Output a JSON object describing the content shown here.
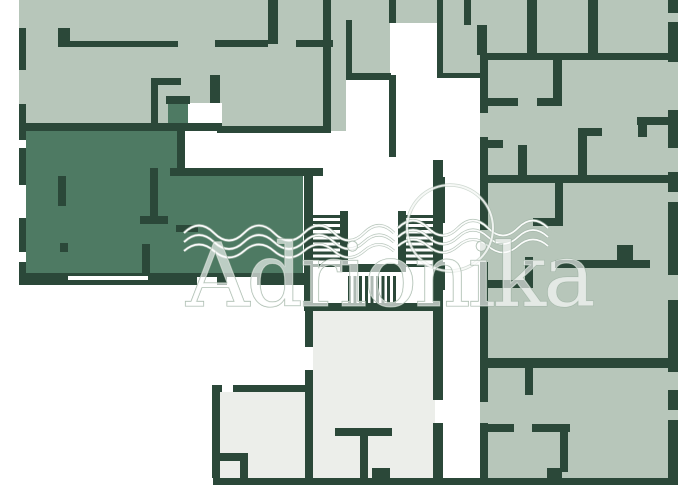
{
  "watermark": {
    "text": "Adrionika"
  },
  "colors": {
    "bg": "#ffffff",
    "room": "#b7c6ba",
    "room-dark": "#4e7a63",
    "room-pale": "#eceeea",
    "wall": "#2b4839",
    "wm-stroke": "#9fb3a4"
  },
  "plan": {
    "width": 692,
    "height": 485,
    "shapes": [
      {
        "t": "sage",
        "n": "apartment-fill-top-left",
        "x": 19,
        "y": 0,
        "w": 424,
        "h": 133
      },
      {
        "t": "sage",
        "n": "apartment-fill-right",
        "x": 443,
        "y": 0,
        "w": 235,
        "h": 478
      },
      {
        "t": "dark",
        "n": "highlighted-apartment-fill",
        "x": 26,
        "y": 128,
        "w": 277,
        "h": 149
      },
      {
        "t": "dark",
        "n": "highlighted-apartment-entry-fill",
        "x": 168,
        "y": 103,
        "w": 20,
        "h": 27
      },
      {
        "t": "pale",
        "n": "apartment-fill-bottom-center",
        "x": 313,
        "y": 310,
        "w": 122,
        "h": 168
      },
      {
        "t": "pale",
        "n": "apartment-fill-bottom-left",
        "x": 220,
        "y": 392,
        "w": 85,
        "h": 86
      },
      {
        "t": "white",
        "n": "door-opening",
        "x": 188,
        "y": 103,
        "w": 34,
        "h": 21
      },
      {
        "t": "white",
        "n": "corridor-area",
        "x": 184,
        "y": 131,
        "w": 259,
        "h": 39
      },
      {
        "t": "white",
        "n": "corridor-area",
        "x": 346,
        "y": 80,
        "w": 43,
        "h": 53
      },
      {
        "t": "white",
        "n": "corridor-area",
        "x": 390,
        "y": 23,
        "w": 47,
        "h": 137
      },
      {
        "t": "white",
        "n": "corridor-area",
        "x": 443,
        "y": 78,
        "w": 37,
        "h": 400
      },
      {
        "t": "white",
        "n": "corridor-area",
        "x": 437,
        "y": 78,
        "w": 6,
        "h": 82
      },
      {
        "t": "wall",
        "n": "exterior-wall-left",
        "x": 19,
        "y": 28,
        "w": 7,
        "h": 42
      },
      {
        "t": "wall",
        "n": "exterior-wall-left",
        "x": 19,
        "y": 104,
        "w": 7,
        "h": 36
      },
      {
        "t": "wall",
        "n": "exterior-wall-left",
        "x": 19,
        "y": 148,
        "w": 7,
        "h": 37
      },
      {
        "t": "wall",
        "n": "exterior-wall-left",
        "x": 19,
        "y": 218,
        "w": 7,
        "h": 34
      },
      {
        "t": "wall",
        "n": "exterior-wall-left",
        "x": 19,
        "y": 262,
        "w": 7,
        "h": 23
      },
      {
        "t": "wall",
        "n": "wall-segment",
        "x": 58,
        "y": 28,
        "w": 12,
        "h": 19
      },
      {
        "t": "wall",
        "n": "wall-segment",
        "x": 58,
        "y": 41,
        "w": 120,
        "h": 6
      },
      {
        "t": "wall",
        "n": "wall-segment",
        "x": 151,
        "y": 78,
        "w": 7,
        "h": 47
      },
      {
        "t": "wall",
        "n": "wall-segment",
        "x": 151,
        "y": 78,
        "w": 30,
        "h": 7
      },
      {
        "t": "wall",
        "n": "wall-segment",
        "x": 210,
        "y": 75,
        "w": 10,
        "h": 28
      },
      {
        "t": "wall",
        "n": "wall-segment",
        "x": 166,
        "y": 96,
        "w": 24,
        "h": 8
      },
      {
        "t": "wall",
        "n": "wall-segment",
        "x": 19,
        "y": 123,
        "w": 203,
        "h": 8
      },
      {
        "t": "wall",
        "n": "wall-segment",
        "x": 217,
        "y": 126,
        "w": 106,
        "h": 7
      },
      {
        "t": "wall",
        "n": "wall-segment",
        "x": 268,
        "y": 0,
        "w": 10,
        "h": 44
      },
      {
        "t": "wall",
        "n": "wall-segment",
        "x": 215,
        "y": 40,
        "w": 53,
        "h": 7
      },
      {
        "t": "wall",
        "n": "wall-segment",
        "x": 296,
        "y": 40,
        "w": 37,
        "h": 7
      },
      {
        "t": "wall",
        "n": "wall-segment",
        "x": 323,
        "y": 0,
        "w": 8,
        "h": 133
      },
      {
        "t": "wall",
        "n": "wall-segment",
        "x": 346,
        "y": 20,
        "w": 6,
        "h": 57
      },
      {
        "t": "wall",
        "n": "wall-segment",
        "x": 346,
        "y": 73,
        "w": 45,
        "h": 7
      },
      {
        "t": "wall",
        "n": "wall-segment",
        "x": 389,
        "y": 0,
        "w": 7,
        "h": 23
      },
      {
        "t": "wall",
        "n": "wall-segment",
        "x": 389,
        "y": 75,
        "w": 7,
        "h": 82
      },
      {
        "t": "wall",
        "n": "wall-segment",
        "x": 437,
        "y": 0,
        "w": 6,
        "h": 78
      },
      {
        "t": "wall",
        "n": "wall-segment",
        "x": 443,
        "y": 73,
        "w": 37,
        "h": 5
      },
      {
        "t": "wall",
        "n": "wall-segment",
        "x": 464,
        "y": 0,
        "w": 7,
        "h": 25
      },
      {
        "t": "wall",
        "n": "wall-segment",
        "x": 477,
        "y": 25,
        "w": 10,
        "h": 30
      },
      {
        "t": "wall",
        "n": "wall-segment",
        "x": 480,
        "y": 53,
        "w": 198,
        "h": 7
      },
      {
        "t": "wall",
        "n": "wall-segment",
        "x": 527,
        "y": 0,
        "w": 10,
        "h": 53
      },
      {
        "t": "wall",
        "n": "wall-segment",
        "x": 588,
        "y": 0,
        "w": 10,
        "h": 53
      },
      {
        "t": "wall",
        "n": "wall-segment",
        "x": 480,
        "y": 60,
        "w": 8,
        "h": 53
      },
      {
        "t": "wall",
        "n": "wall-segment",
        "x": 480,
        "y": 137,
        "w": 8,
        "h": 93
      },
      {
        "t": "wall",
        "n": "wall-segment",
        "x": 480,
        "y": 262,
        "w": 8,
        "h": 140
      },
      {
        "t": "wall",
        "n": "wall-segment",
        "x": 480,
        "y": 423,
        "w": 8,
        "h": 55
      },
      {
        "t": "wall",
        "n": "wall-segment",
        "x": 488,
        "y": 175,
        "w": 190,
        "h": 8
      },
      {
        "t": "wall",
        "n": "wall-segment",
        "x": 488,
        "y": 98,
        "w": 30,
        "h": 8
      },
      {
        "t": "wall",
        "n": "wall-segment",
        "x": 537,
        "y": 98,
        "w": 25,
        "h": 8
      },
      {
        "t": "wall",
        "n": "wall-segment",
        "x": 553,
        "y": 60,
        "w": 9,
        "h": 46
      },
      {
        "t": "wall",
        "n": "wall-segment",
        "x": 488,
        "y": 140,
        "w": 15,
        "h": 8
      },
      {
        "t": "wall",
        "n": "wall-segment",
        "x": 518,
        "y": 145,
        "w": 9,
        "h": 38
      },
      {
        "t": "wall",
        "n": "wall-segment",
        "x": 578,
        "y": 128,
        "w": 9,
        "h": 55
      },
      {
        "t": "wall",
        "n": "wall-segment",
        "x": 578,
        "y": 128,
        "w": 24,
        "h": 8
      },
      {
        "t": "wall",
        "n": "wall-segment",
        "x": 637,
        "y": 117,
        "w": 33,
        "h": 8
      },
      {
        "t": "wall",
        "n": "wall-segment",
        "x": 638,
        "y": 117,
        "w": 9,
        "h": 20
      },
      {
        "t": "wall",
        "n": "wall-segment",
        "x": 555,
        "y": 183,
        "w": 8,
        "h": 42
      },
      {
        "t": "wall",
        "n": "wall-segment",
        "x": 533,
        "y": 218,
        "w": 30,
        "h": 8
      },
      {
        "t": "wall",
        "n": "wall-segment",
        "x": 555,
        "y": 260,
        "w": 95,
        "h": 8
      },
      {
        "t": "wall",
        "n": "wall-segment",
        "x": 617,
        "y": 245,
        "w": 16,
        "h": 15
      },
      {
        "t": "wall",
        "n": "wall-segment",
        "x": 485,
        "y": 280,
        "w": 48,
        "h": 8
      },
      {
        "t": "wall",
        "n": "wall-segment",
        "x": 525,
        "y": 257,
        "w": 8,
        "h": 23
      },
      {
        "t": "wall",
        "n": "wall-segment",
        "x": 488,
        "y": 358,
        "w": 187,
        "h": 10
      },
      {
        "t": "wall",
        "n": "wall-segment",
        "x": 525,
        "y": 368,
        "w": 8,
        "h": 27
      },
      {
        "t": "wall",
        "n": "wall-segment",
        "x": 486,
        "y": 424,
        "w": 28,
        "h": 8
      },
      {
        "t": "wall",
        "n": "wall-segment",
        "x": 532,
        "y": 424,
        "w": 38,
        "h": 8
      },
      {
        "t": "wall",
        "n": "wall-segment",
        "x": 560,
        "y": 432,
        "w": 8,
        "h": 40
      },
      {
        "t": "wall",
        "n": "wall-segment",
        "x": 547,
        "y": 468,
        "w": 15,
        "h": 10
      },
      {
        "t": "wall",
        "n": "exterior-wall-right",
        "x": 668,
        "y": 0,
        "w": 10,
        "h": 13
      },
      {
        "t": "wall",
        "n": "exterior-wall-right",
        "x": 668,
        "y": 22,
        "w": 10,
        "h": 40
      },
      {
        "t": "wall",
        "n": "exterior-wall-right",
        "x": 668,
        "y": 110,
        "w": 10,
        "h": 38
      },
      {
        "t": "wall",
        "n": "exterior-wall-right",
        "x": 668,
        "y": 172,
        "w": 10,
        "h": 20
      },
      {
        "t": "wall",
        "n": "exterior-wall-right",
        "x": 668,
        "y": 202,
        "w": 10,
        "h": 73
      },
      {
        "t": "wall",
        "n": "exterior-wall-right",
        "x": 668,
        "y": 300,
        "w": 10,
        "h": 72
      },
      {
        "t": "wall",
        "n": "exterior-wall-right",
        "x": 668,
        "y": 390,
        "w": 10,
        "h": 20
      },
      {
        "t": "wall",
        "n": "exterior-wall-right",
        "x": 668,
        "y": 420,
        "w": 10,
        "h": 58
      },
      {
        "t": "wall",
        "n": "exterior-wall-bottom",
        "x": 213,
        "y": 478,
        "w": 465,
        "h": 7
      },
      {
        "t": "wall",
        "n": "wall-segment",
        "x": 170,
        "y": 168,
        "w": 153,
        "h": 8
      },
      {
        "t": "wall",
        "n": "wall-segment",
        "x": 177,
        "y": 131,
        "w": 8,
        "h": 45
      },
      {
        "t": "wall",
        "n": "wall-segment",
        "x": 150,
        "y": 168,
        "w": 8,
        "h": 48
      },
      {
        "t": "wall",
        "n": "wall-segment",
        "x": 140,
        "y": 216,
        "w": 28,
        "h": 8
      },
      {
        "t": "wall",
        "n": "wall-segment",
        "x": 142,
        "y": 244,
        "w": 8,
        "h": 29
      },
      {
        "t": "wall",
        "n": "wall-segment",
        "x": 58,
        "y": 176,
        "w": 8,
        "h": 30
      },
      {
        "t": "wall",
        "n": "wall-segment",
        "x": 60,
        "y": 243,
        "w": 8,
        "h": 9
      },
      {
        "t": "wall",
        "n": "wall-segment",
        "x": 176,
        "y": 225,
        "w": 22,
        "h": 7
      },
      {
        "t": "wall",
        "n": "exterior-wall-bottom",
        "x": 19,
        "y": 273,
        "w": 291,
        "h": 12
      },
      {
        "t": "white",
        "n": "window-gap",
        "x": 68,
        "y": 276,
        "w": 80,
        "h": 4
      },
      {
        "t": "white",
        "n": "window-gap",
        "x": 197,
        "y": 277,
        "w": 20,
        "h": 8
      },
      {
        "t": "white",
        "n": "window-gap",
        "x": 227,
        "y": 277,
        "w": 30,
        "h": 8
      },
      {
        "t": "wall",
        "n": "stairwell-wall",
        "x": 304,
        "y": 168,
        "w": 9,
        "h": 143
      },
      {
        "t": "wall",
        "n": "stairwell-wall",
        "x": 433,
        "y": 160,
        "w": 10,
        "h": 150
      },
      {
        "t": "wall",
        "n": "stairwell-wall",
        "x": 304,
        "y": 303,
        "w": 139,
        "h": 8
      },
      {
        "t": "wall",
        "n": "stair-newel-wall",
        "x": 340,
        "y": 211,
        "w": 8,
        "h": 61
      },
      {
        "t": "wall",
        "n": "stair-newel-wall",
        "x": 398,
        "y": 211,
        "w": 8,
        "h": 61
      },
      {
        "t": "wall",
        "n": "stair-newel-wall",
        "x": 340,
        "y": 264,
        "w": 66,
        "h": 8
      },
      {
        "t": "wall",
        "n": "wall-segment",
        "x": 437,
        "y": 177,
        "w": 8,
        "h": 46
      },
      {
        "t": "wall",
        "n": "wall-segment",
        "x": 437,
        "y": 262,
        "w": 8,
        "h": 28
      },
      {
        "t": "treads-h",
        "n": "stair-treads-left",
        "x": 313,
        "y": 215,
        "w": 27,
        "h": 53
      },
      {
        "t": "treads-h",
        "n": "stair-treads-right",
        "x": 406,
        "y": 215,
        "w": 27,
        "h": 53
      },
      {
        "t": "treads-v",
        "n": "stair-treads-bottom",
        "x": 348,
        "y": 276,
        "w": 50,
        "h": 27
      },
      {
        "t": "wall",
        "n": "wall-segment",
        "x": 305,
        "y": 311,
        "w": 8,
        "h": 36
      },
      {
        "t": "wall",
        "n": "wall-segment",
        "x": 305,
        "y": 370,
        "w": 8,
        "h": 108
      },
      {
        "t": "wall",
        "n": "wall-segment",
        "x": 335,
        "y": 428,
        "w": 57,
        "h": 8
      },
      {
        "t": "wall",
        "n": "wall-segment",
        "x": 360,
        "y": 436,
        "w": 8,
        "h": 42
      },
      {
        "t": "wall",
        "n": "wall-segment",
        "x": 372,
        "y": 468,
        "w": 18,
        "h": 10
      },
      {
        "t": "wall",
        "n": "wall-segment",
        "x": 433,
        "y": 310,
        "w": 10,
        "h": 90
      },
      {
        "t": "wall",
        "n": "wall-segment",
        "x": 433,
        "y": 423,
        "w": 10,
        "h": 55
      },
      {
        "t": "wall",
        "n": "wall-segment",
        "x": 212,
        "y": 385,
        "w": 98,
        "h": 7
      },
      {
        "t": "wall",
        "n": "wall-segment",
        "x": 212,
        "y": 392,
        "w": 8,
        "h": 86
      },
      {
        "t": "wall",
        "n": "wall-segment",
        "x": 212,
        "y": 453,
        "w": 36,
        "h": 8
      },
      {
        "t": "wall",
        "n": "wall-segment",
        "x": 240,
        "y": 453,
        "w": 8,
        "h": 25
      },
      {
        "t": "white",
        "n": "door-gap",
        "x": 222,
        "y": 385,
        "w": 11,
        "h": 7
      }
    ]
  }
}
